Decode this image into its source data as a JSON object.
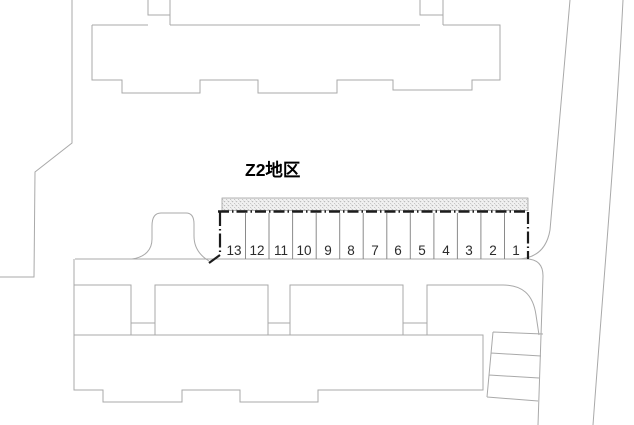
{
  "plan": {
    "district_label": "Z2地区",
    "parking_row": {
      "stall_count": 13,
      "stall_numbers": [
        "13",
        "12",
        "11",
        "10",
        "9",
        "8",
        "7",
        "6",
        "5",
        "4",
        "3",
        "2",
        "1"
      ]
    },
    "small_lot": {
      "stall_count": 3
    },
    "colors": {
      "outline_gray": "#a9a9a9",
      "divider_gray": "#8a8a8a",
      "parking_boundary_black": "#1c1c1c",
      "hatch_fill": "#f1f1f1",
      "hatch_dot": "#bcbcbc",
      "text_black": "#000000"
    }
  }
}
